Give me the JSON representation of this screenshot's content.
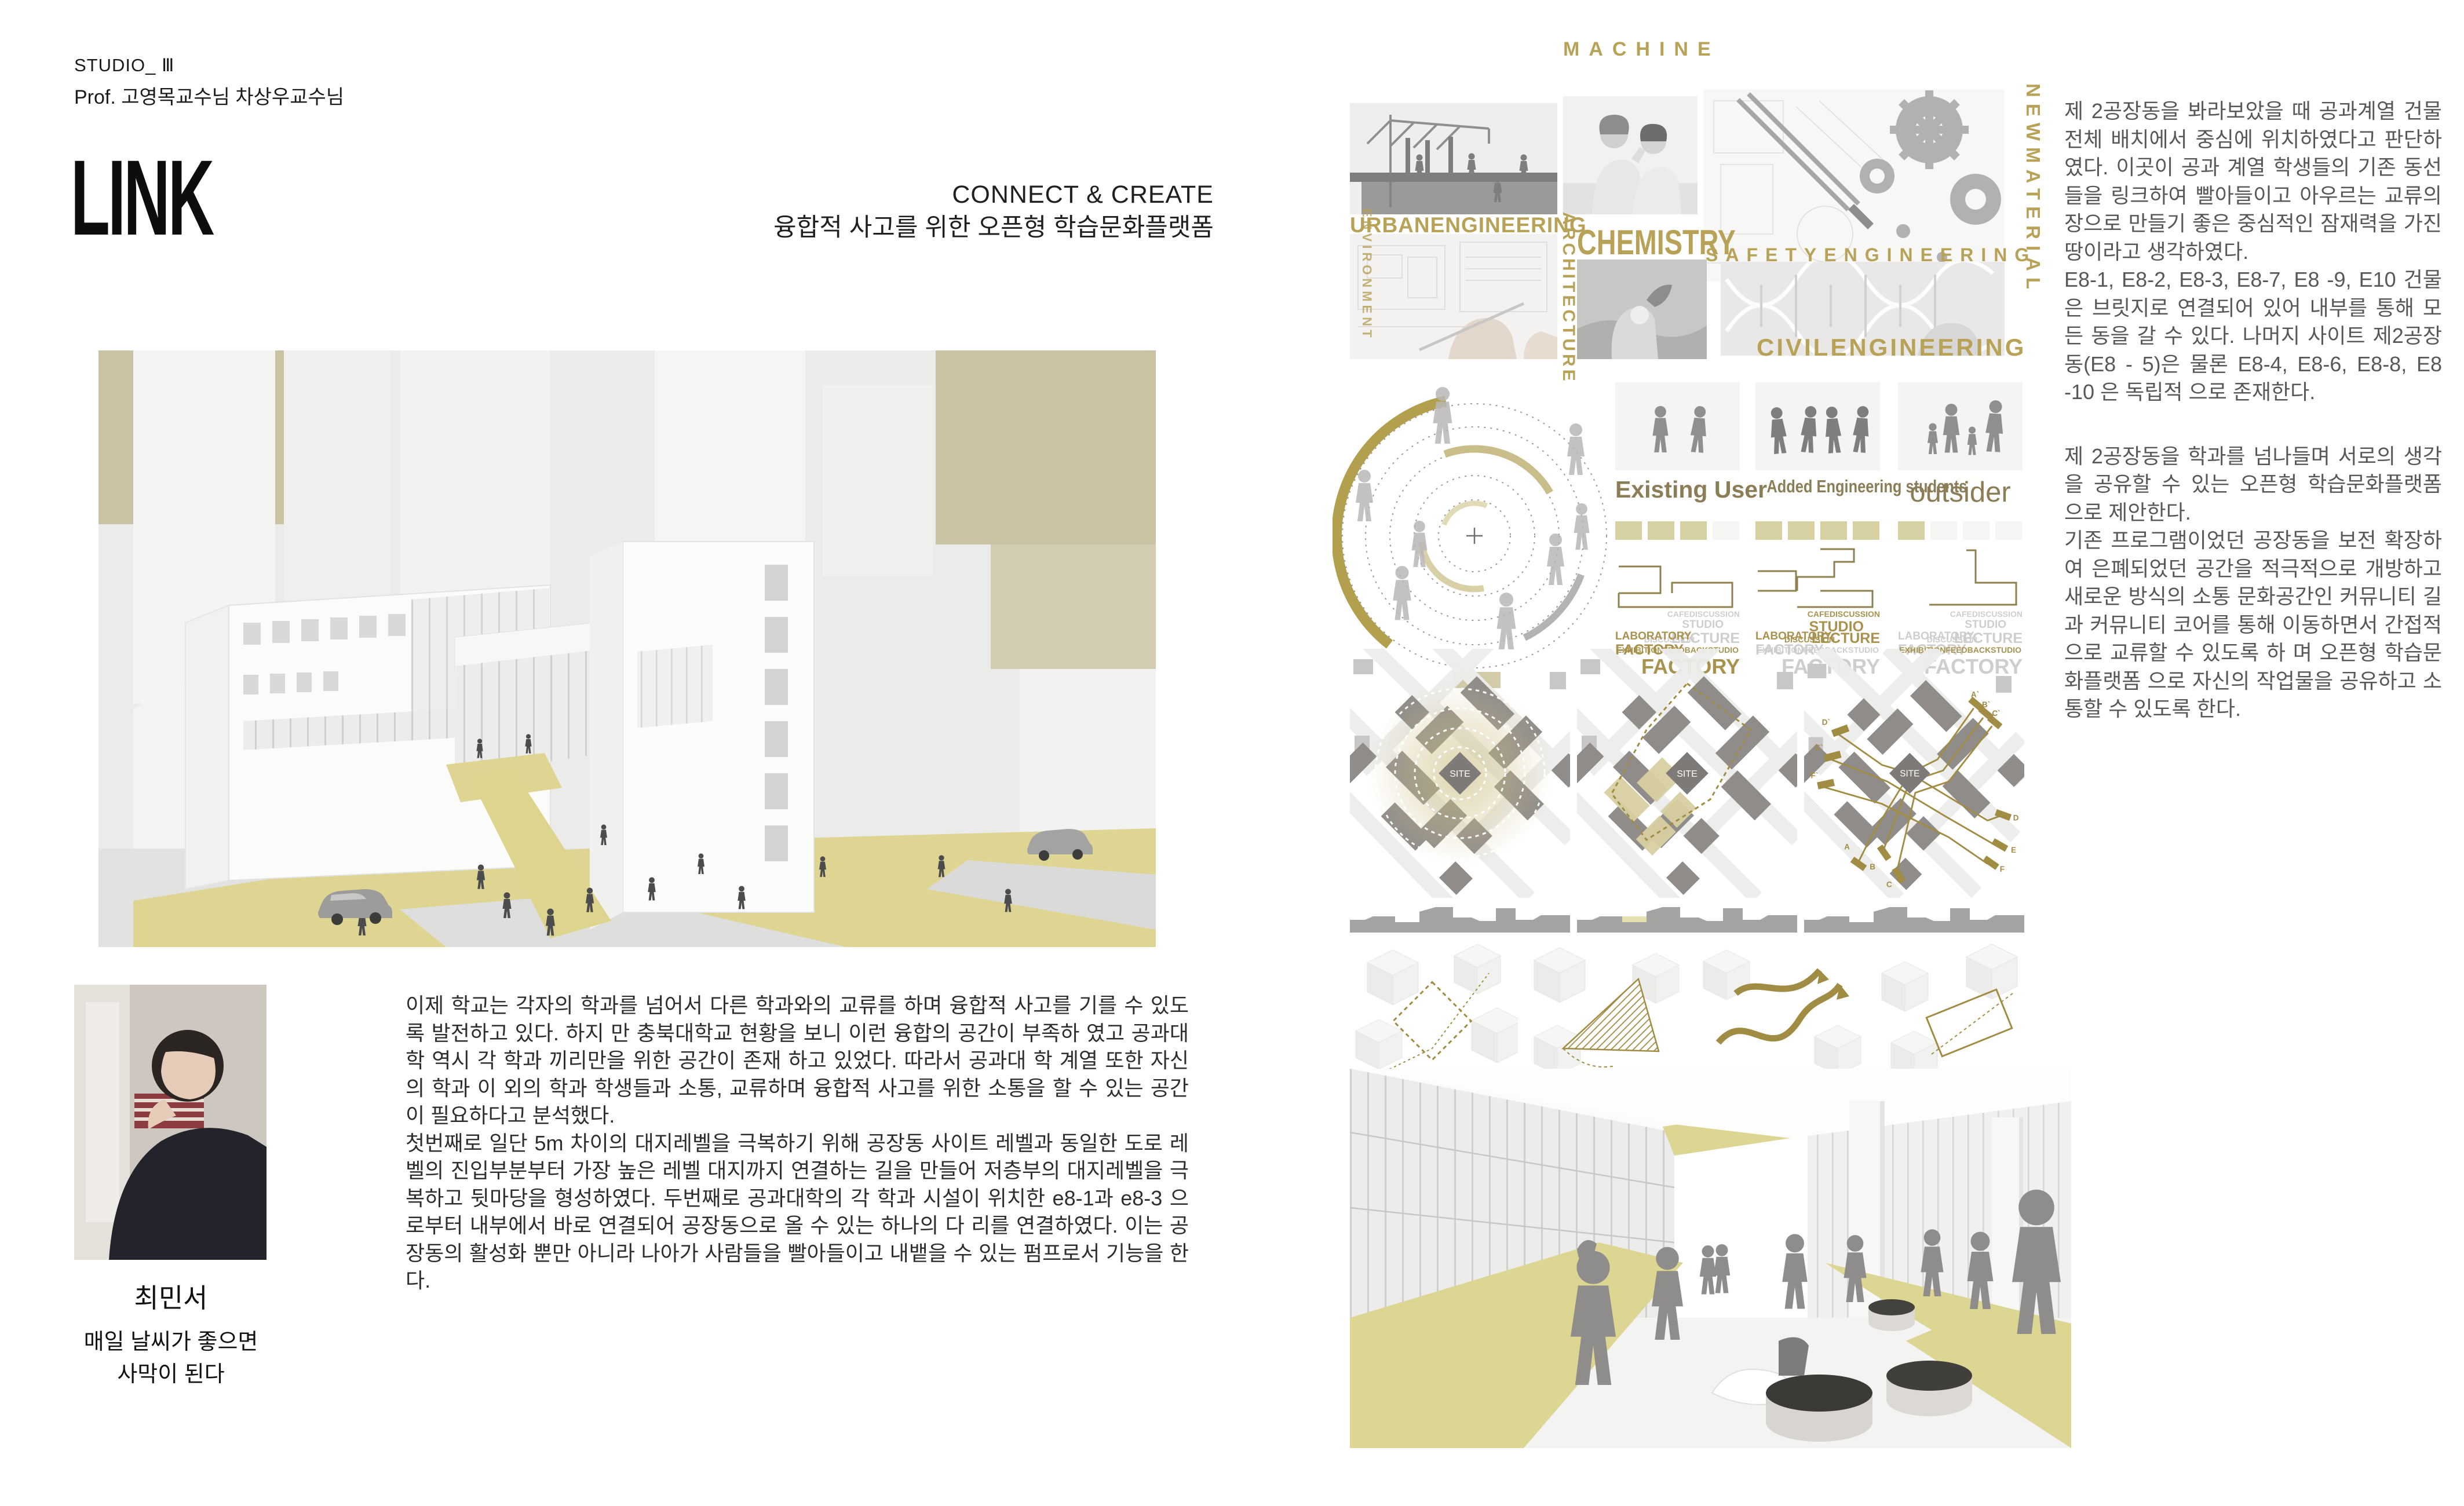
{
  "page": {
    "accent_gold": "#b7a257",
    "accent_olive": "#8b7d56",
    "accent_yellow": "#ded593",
    "khaki_block": "#c9c3a4",
    "map_building_grey": "#8f8c89"
  },
  "header": {
    "studio": "STUDIO_ Ⅲ",
    "professors": "Prof. 고영목교수님 차상우교수님",
    "title": "LINK",
    "subtitle_en": "CONNECT & CREATE",
    "subtitle_ko": "융합적 사고를 위한 오픈형 학습문화플랫폼"
  },
  "author": {
    "name": "최민서",
    "motto_line1": "매일 날씨가 좋으면",
    "motto_line2": "사막이 된다"
  },
  "intro": {
    "para1": " 이제 학교는 각자의 학과를 넘어서 다른 학과와의 교류를 하며 융합적 사고를 기를 수 있도록 발전하고 있다. 하지 만 충북대학교 현황을 보니 이런 융합의 공간이 부족하 였고 공과대학 역시 각 학과 끼리만을 위한 공간이 존재 하고 있었다. 따라서 공과대 학 계열 또한 자신의 학과 이 외의 학과 학생들과 소통, 교류하며 융합적 사고를 위한 소통을 할 수 있는 공간이 필요하다고 분석했다.",
    "para2": " 첫번째로 일단 5m 차이의 대지레벨을 극복하기 위해 공장동 사이트 레벨과 동일한 도로 레벨의 진입부분부터 가장 높은 레벨 대지까지 연결하는 길을 만들어 저층부의 대지레벨을 극복하고 뒷마당을 형성하였다. 두번째로 공과대학의 각 학과 시설이 위치한 e8-1과 e8-3 으로부터 내부에서 바로 연결되어 공장동으로 올 수 있는 하나의 다 리를 연결하였다. 이는 공장동의 활성화 뿐만 아니라 나아가 사람들을 빨아들이고 내뱉을 수 있는 펌프로서 기능을 한다."
  },
  "collage": {
    "machine": "MACHINE",
    "urban": "URBANENGINEERING",
    "architecture": "ARCHITECTURE",
    "chemistry": "CHEMISTRY",
    "safety": "SAFETYENGINEERING",
    "civil": "CIVILENGINEERING",
    "newmaterial": "NEWMATERIAL",
    "environment": "ENVIRONMENT"
  },
  "diagram": {
    "groups": [
      {
        "label": "Existing User",
        "squares": [
          "gold",
          "gold",
          "gold",
          "light"
        ],
        "cloud": [
          {
            "t": "CAFEDISCUSSION",
            "tone": "grey"
          },
          {
            "t": "STUDIO",
            "tone": "grey"
          },
          {
            "t": "LECTURE",
            "tone": "grey"
          },
          {
            "t": "DISCUSSION",
            "tone": "grey"
          },
          {
            "t": "LABORATORY",
            "tone": "gold"
          },
          {
            "t": "FACTORY",
            "tone": "gold"
          },
          {
            "t": "EXHIBITIONFEEDBACKSTUDIO",
            "tone": "gold"
          },
          {
            "t": "FACTORY",
            "tone": "gold"
          }
        ]
      },
      {
        "label": "Added Engineering students",
        "squares": [
          "gold",
          "gold",
          "gold",
          "gold"
        ],
        "cloud": [
          {
            "t": "CAFEDISCUSSION",
            "tone": "gold"
          },
          {
            "t": "STUDIO",
            "tone": "gold"
          },
          {
            "t": "LECTURE",
            "tone": "gold"
          },
          {
            "t": "DISCUSSION",
            "tone": "gold"
          },
          {
            "t": "LABORATORY",
            "tone": "gold"
          },
          {
            "t": "FACTORY",
            "tone": "grey"
          },
          {
            "t": "EXHIBITIONFEEDBACKSTUDIO",
            "tone": "grey"
          },
          {
            "t": "FACTORY",
            "tone": "grey"
          }
        ]
      },
      {
        "label": "outsider",
        "squares": [
          "gold",
          "light",
          "light",
          "light"
        ],
        "cloud": [
          {
            "t": "CAFEDISCUSSION",
            "tone": "grey"
          },
          {
            "t": "STUDIO",
            "tone": "grey"
          },
          {
            "t": "LECTURE",
            "tone": "grey"
          },
          {
            "t": "DISCUSSION",
            "tone": "grey"
          },
          {
            "t": "LABORATORY",
            "tone": "grey"
          },
          {
            "t": "FACTORY",
            "tone": "grey"
          },
          {
            "t": "EXHIBITIONFEEDBACKSTUDIO",
            "tone": "gold"
          },
          {
            "t": "FACTORY",
            "tone": "grey"
          }
        ]
      }
    ]
  },
  "maps": {
    "site": "SITE",
    "routes": [
      "A",
      "B",
      "C",
      "D",
      "E",
      "F"
    ],
    "routes_prime": [
      "A`",
      "B`",
      "C`",
      "D`",
      "E`",
      "F`"
    ]
  },
  "right_column": {
    "para1": " 제 2공장동을 봐라보았을 때 공과계열 건물 전체 배치에서 중심에 위치하였다고 판단하였다. 이곳이 공과 계열  학생들의 기존 동선들을 링크하여 빨아들이고 아우르는 교류의 장으로 만들기 좋은 중심적인 잠재력을 가진 땅이라고 생각하였다.\n E8-1, E8-2, E8-3, E8-7, E8 -9, E10 건물은  브릿지로 연결되어 있어 내부를 통해 모든 동을 갈 수 있다. 나머지 사이트 제2공장동(E8 - 5)은 물론 E8-4, E8-6, E8-8, E8 -10 은 독립적 으로 존재한다.",
    "para2": " 제 2공장동을 학과를 넘나들며 서로의 생각을 공유할 수 있는 오픈형 학습문화플랫폼 으로 제안한다.\n기존 프로그램이었던 공장동을 보전 확장하여 은폐되었던 공간을 적극적으로 개방하고 새로운 방식의 소통 문화공간인 커뮤니티 길과 커뮤니티 코어를 통해 이동하면서 간접적으로 교류할 수 있도록 하 며 오픈형 학습문화플랫폼 으로 자신의 작업물을 공유하고 소통할 수 있도록 한다."
  }
}
